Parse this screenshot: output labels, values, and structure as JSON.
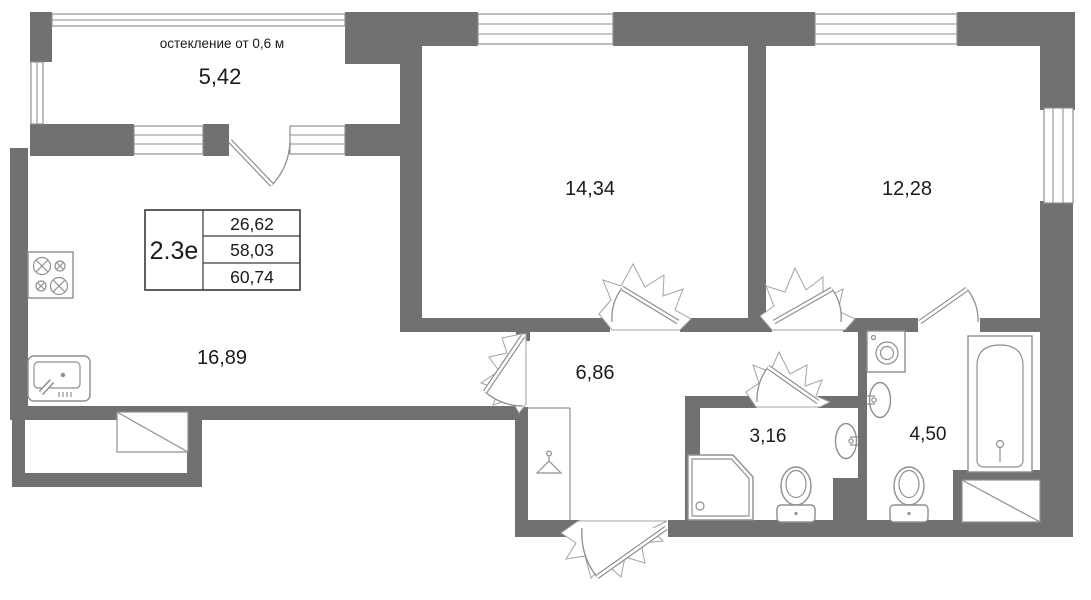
{
  "plan": {
    "balcony": {
      "note": "остекление от 0,6 м",
      "area": "5,42"
    },
    "rooms": [
      {
        "name": "bedroom-1",
        "area": "14,34"
      },
      {
        "name": "bedroom-2",
        "area": "12,28"
      },
      {
        "name": "kitchen-living-room",
        "area": "16,89"
      },
      {
        "name": "hallway",
        "area": "6,86"
      },
      {
        "name": "shower-room",
        "area": "3,16"
      },
      {
        "name": "bathroom",
        "area": "4,50"
      }
    ],
    "spec_table": {
      "plan_type": "2.3е",
      "values": [
        "26,62",
        "58,03",
        "60,74"
      ]
    },
    "colors": {
      "wall": "#717171",
      "outline": "#8f8f8f",
      "text": "#1a1a1a",
      "background": "#ffffff"
    },
    "icons": [
      "stove-icon",
      "kitchen-sink-icon",
      "coat-hanger-icon",
      "shower-cabin-icon",
      "toilet-icon",
      "wall-sink-icon",
      "washing-machine-icon",
      "bathtub-icon",
      "duct-shaft-icon",
      "window-icon",
      "door-swing-icon"
    ]
  }
}
